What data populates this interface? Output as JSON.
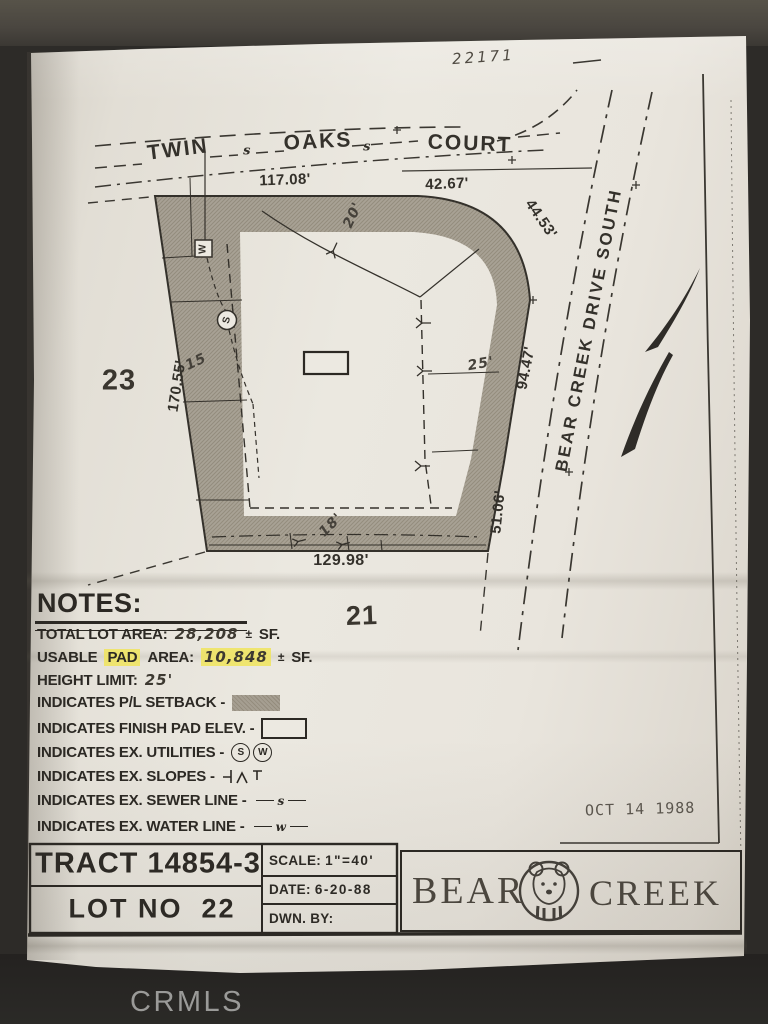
{
  "annotations": {
    "handwritten_number": "22171",
    "date_stamp": "OCT 14 1988",
    "watermark": "CRMLS"
  },
  "map": {
    "streets": {
      "top_name_1": "TWIN",
      "top_name_2": "OAKS",
      "top_name_3": "COURT",
      "sewer_letter": "s",
      "right_name": "BEAR CREEK DRIVE SOUTH"
    },
    "dimensions": {
      "top_left": "117.08'",
      "top_right": "42.67'",
      "curve": "44.53'",
      "right_upper": "94.47'",
      "right_lower": "51.06'",
      "bottom": "129.98'",
      "left": "170.55'"
    },
    "setback_widths": {
      "top": "20'",
      "left": "15",
      "right": "25'",
      "bottom": "18'"
    },
    "adjacent_lots": {
      "west": "23",
      "south": "21"
    },
    "utility_marks": {
      "water": "W",
      "sewer": "S"
    }
  },
  "notes": {
    "heading": "NOTES:",
    "total_lot": {
      "label": "TOTAL LOT AREA:",
      "value": "28,208",
      "pm": "±",
      "unit": "SF."
    },
    "usable_pad": {
      "word1": "USABLE",
      "word2": "PAD",
      "word3": "AREA:",
      "value": "10,848",
      "pm": "±",
      "unit": "SF."
    },
    "height_limit": {
      "label": "HEIGHT LIMIT:",
      "value": "25'"
    },
    "setback_row": {
      "label": "INDICATES P/L SETBACK -"
    },
    "finish_pad_row": {
      "label": "INDICATES FINISH PAD ELEV. -"
    },
    "utilities_row": {
      "label": "INDICATES EX. UTILITIES -",
      "s": "S",
      "w": "W"
    },
    "slopes_row": {
      "label": "INDICATES EX. SLOPES -"
    },
    "sewer_row": {
      "label": "INDICATES EX. SEWER LINE -",
      "letter": "s"
    },
    "water_row": {
      "label": "INDICATES EX. WATER LINE -",
      "letter": "w"
    }
  },
  "title_block": {
    "tract": "TRACT 14854-3",
    "lot": "LOT NO  22",
    "scale_label": "SCALE:",
    "scale_value": "1\"=40'",
    "date_label": "DATE:",
    "date_value": "6-20-88",
    "dwn_label": "DWN. BY:"
  },
  "logo": {
    "word1": "BEAR",
    "word2": "CREEK"
  },
  "colors": {
    "highlight": "#f2e96d",
    "paper": "#e8e4db",
    "ink": "#34312b",
    "setback_gray": "#a59e91"
  }
}
